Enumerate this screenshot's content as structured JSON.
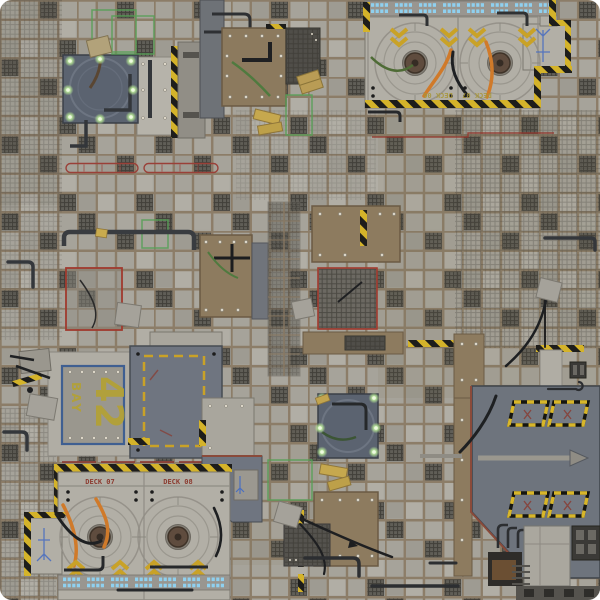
{
  "meta": {
    "description": "Top-down sci-fi industrial battle mat with tiled deck floor, landing platforms, hazard striping and service bays"
  },
  "markings": {
    "bay": {
      "line1": "BAY",
      "line2": "42"
    },
    "deck_top": {
      "left": "DECK 06",
      "right": "DECK 07"
    },
    "deck_bottom": {
      "left": "DECK 07",
      "right": "DECK 08"
    }
  },
  "palette": {
    "tile": "#a6a39a",
    "tile_grout": "#8b7b65",
    "mesh_panel": "#565450",
    "concrete_platform": "#b2afa6",
    "dark_platform": "#6e747d",
    "rotary_pad": "#5b6370",
    "rust_platform": "#8d7b5f",
    "hazard_yellow": "#d4b32a",
    "hazard_black": "#1d1d1b",
    "marking_red": "#9a3a30",
    "wire_green": "#55a055",
    "glow_green": "#c9f0a8",
    "edge_light_blue": "#8fd0ef",
    "hose_orange": "#d07a2a",
    "bay_border_blue": "#3f5f91",
    "bay_label_yellow": "#b3a135",
    "deck_label_red": "#8c3b30",
    "diagram_blue": "#4a6fc0"
  },
  "features": [
    "floor-tile-grid",
    "mesh-floor-panels",
    "landing-platform-north",
    "landing-platform-south",
    "deck-pad-circles",
    "hazard-striped-borders",
    "bay-42-marking",
    "red-floor-lane-markings",
    "rust-metal-platforms",
    "dark-service-platforms",
    "rotary-pads-with-green-lights",
    "blue-edge-lights",
    "orange-supply-hoses",
    "black-cables",
    "green-conduit-wires",
    "yellow-supply-crates",
    "vent-hatches-south-east",
    "pipe-runs",
    "annex-panels-with-blue-diagrams"
  ]
}
